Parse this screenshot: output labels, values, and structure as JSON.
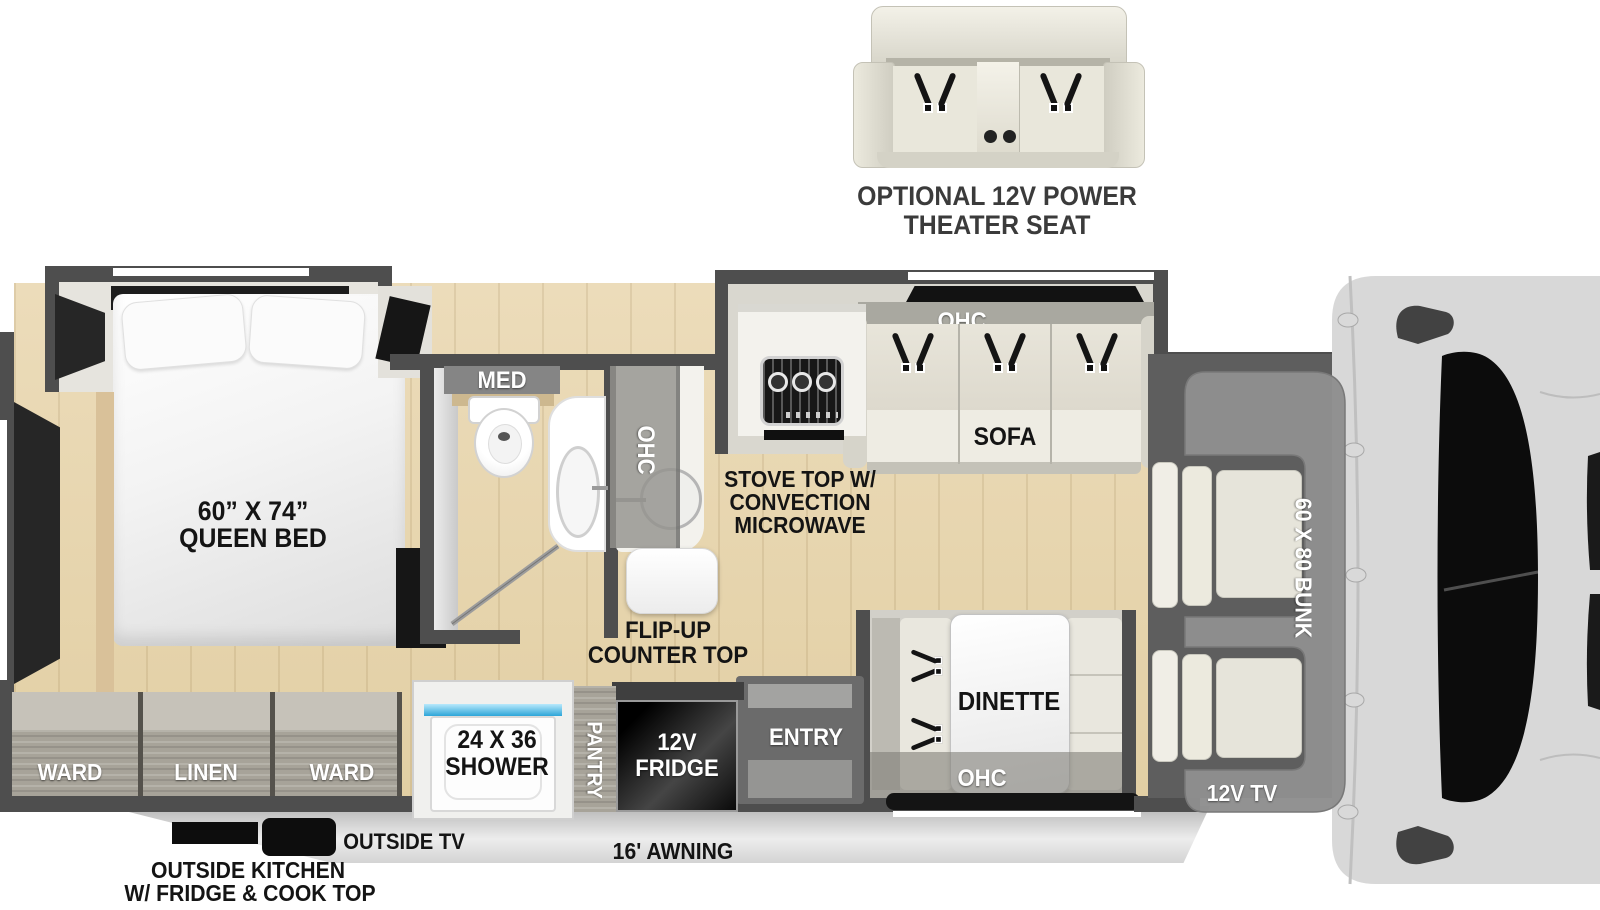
{
  "colors": {
    "wall": "#4e4e4e",
    "floor_wood": "#e7d6b2",
    "slide_interior": "#d9d7cf",
    "cabinet_wood": "#a7a399",
    "seat_cream": "#e9e7dc",
    "fridge_black": "#0d0d0d",
    "shower_water": "#45b7e8",
    "bunk_overlay": "#8e8e8e",
    "truck_body": "#d8d8d8",
    "windshield": "#0c0c0c",
    "label_dark": "#141414",
    "label_light": "#ffffff"
  },
  "theater_seat": {
    "label_line1": "OPTIONAL 12V POWER",
    "label_line2": "THEATER SEAT"
  },
  "bedroom": {
    "bed_size_line1": "60” X 74”",
    "bed_size_line2": "QUEEN BED"
  },
  "bathroom": {
    "med_cabinet": "MED"
  },
  "kitchen": {
    "overhead_cabinet": "OHC",
    "flip_up_line1": "FLIP-UP",
    "flip_up_line2": "COUNTER TOP",
    "stove_line1": "STOVE TOP W/",
    "stove_line2": "CONVECTION",
    "stove_line3": "MICROWAVE"
  },
  "living": {
    "overhead_cabinet": "OHC",
    "sofa": "SOFA"
  },
  "dinette": {
    "label": "DINETTE",
    "overhead_cabinet": "OHC"
  },
  "galley_wall": {
    "entry": "ENTRY",
    "fridge_line1": "12V",
    "fridge_line2": "FRIDGE",
    "pantry": "PANTRY",
    "shower_line1": "24 X 36",
    "shower_line2": "SHOWER"
  },
  "rear_storage": {
    "ward_left": "WARD",
    "linen": "LINEN",
    "ward_right": "WARD"
  },
  "cab": {
    "bunk": "60 X 80 BUNK",
    "tv": "12V TV"
  },
  "exterior": {
    "outside_tv": "OUTSIDE TV",
    "awning": "16' AWNING",
    "outside_kitchen_line1": "OUTSIDE KITCHEN",
    "outside_kitchen_line2": "W/ FRIDGE & COOK TOP"
  }
}
